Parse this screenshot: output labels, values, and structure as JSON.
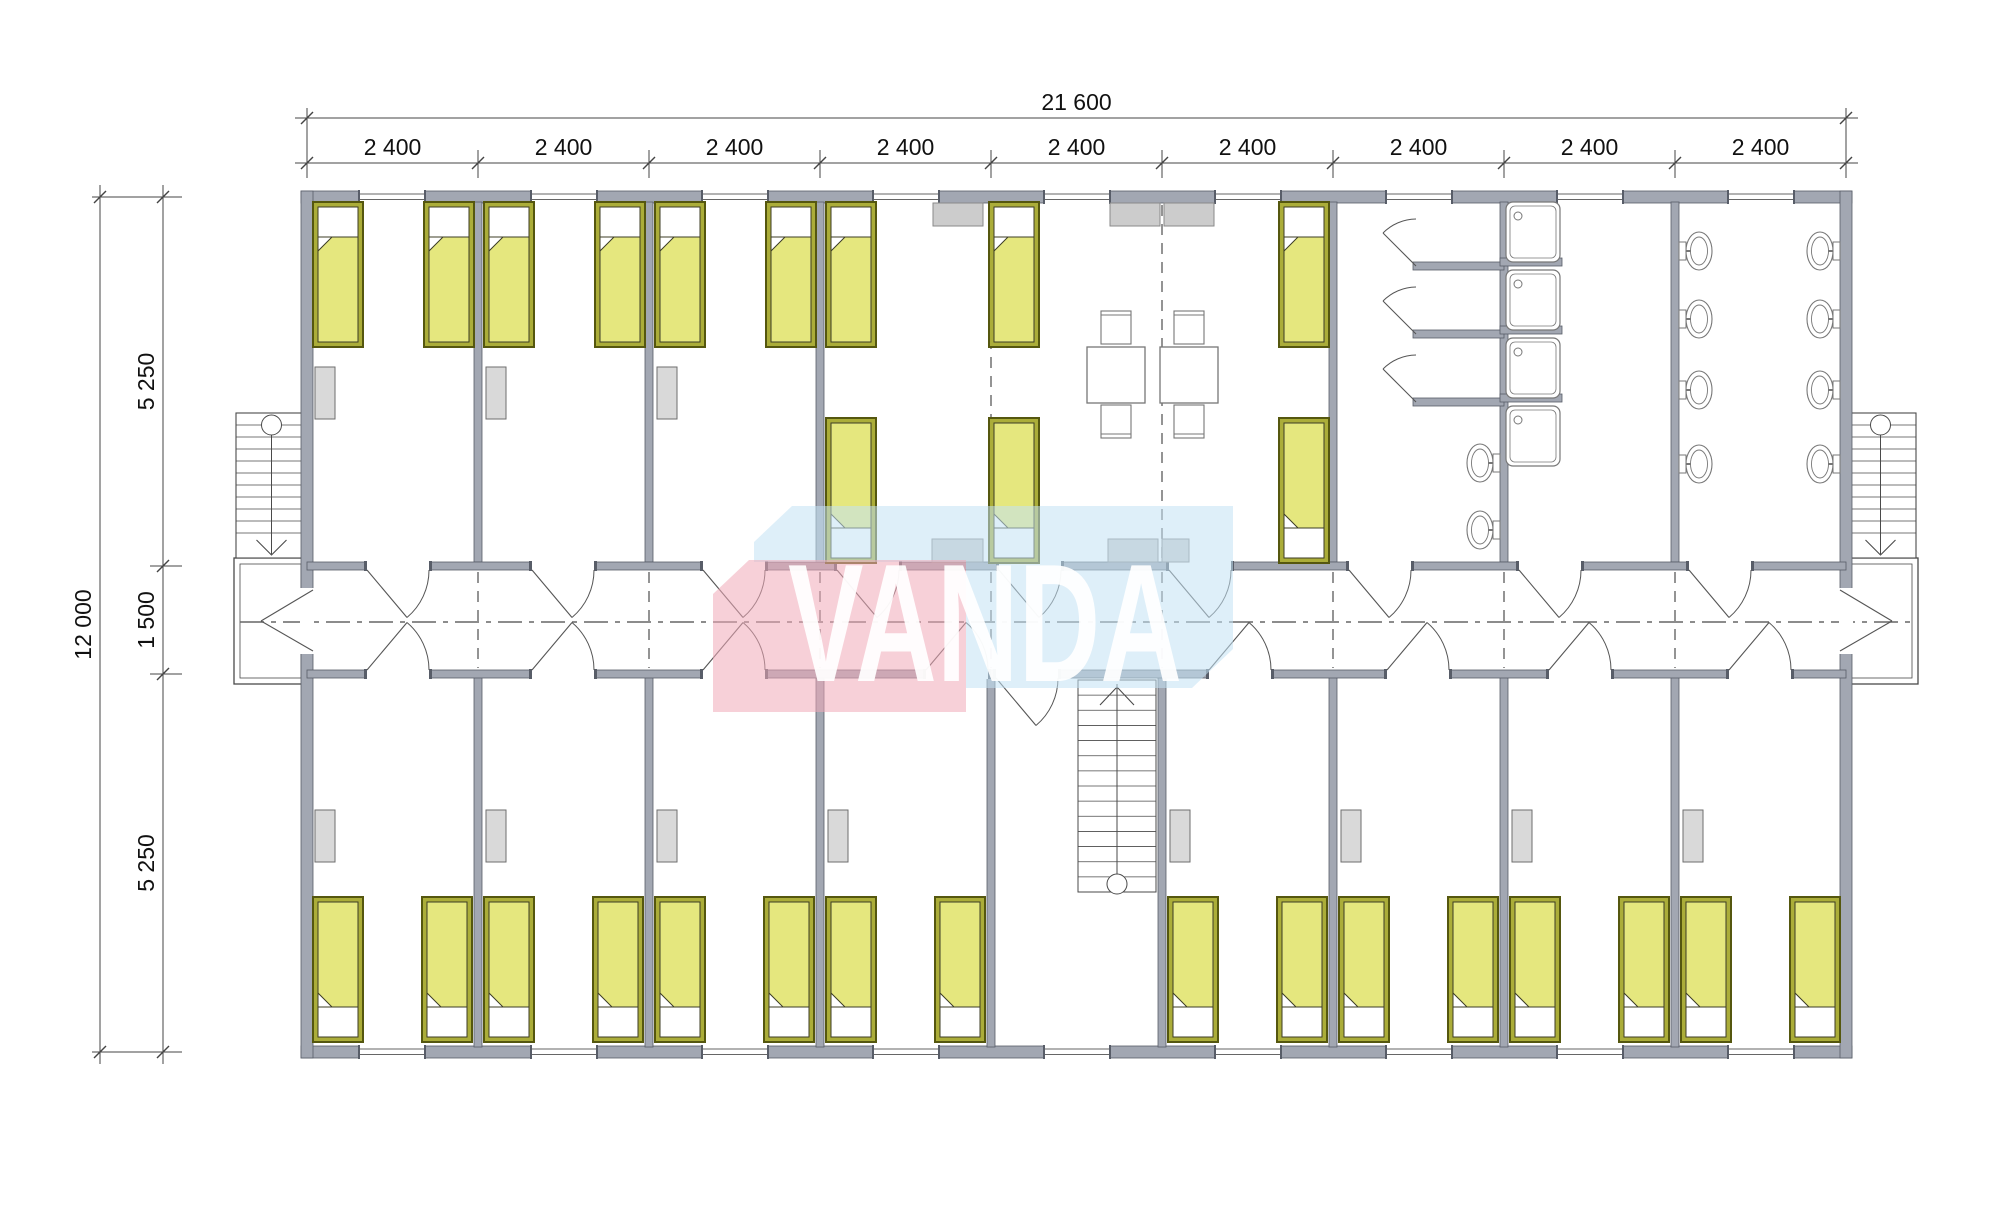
{
  "dimensions": {
    "top_total": "21 600",
    "top_segment_labels": [
      "2 400",
      "2 400",
      "2 400",
      "2 400",
      "2 400",
      "2 400",
      "2 400",
      "2 400",
      "2 400"
    ],
    "left_total": "12 000",
    "left_segment_labels": [
      "5 250",
      "1 500",
      "5 250"
    ]
  },
  "watermark": {
    "text": "VANDA",
    "pink": "#f0a9b8",
    "blue": "#c2e2f4",
    "text_color": "#ffffff",
    "pink_points": "713,594 749,560 966,560 966,712 713,712",
    "blue_points": "754,542 792,506 1233,506 1233,649 1192,688 966,688 966,562 754,562",
    "text_x": 788,
    "text_y": 681,
    "text_size": 168,
    "text_length": 394
  },
  "colors": {
    "wall_fill": "#a2a7b2",
    "wall_edge": "#585d68",
    "thin_line": "#666666",
    "dim_line": "#444444",
    "dim_text": "#111111",
    "bed_frame": "#abad39",
    "bed_frame_edge": "#55570f",
    "mattress": "#e5e77e",
    "mattress_edge": "#3c3c25",
    "pillow": "#ffffff",
    "wardrobe_fill": "#d9d9d9",
    "wardrobe_edge": "#6e6e6e",
    "cabinet_fill": "#cccccc",
    "cabinet_edge": "#8a8a8a",
    "fixture_line": "#777777",
    "stair_line": "#4a4a4a"
  },
  "plan": {
    "x0": 307,
    "module": 171,
    "modules": 9,
    "y_top": 197,
    "y_corr_top": 566,
    "y_corr_bot": 674,
    "y_bot": 1052,
    "ext_thick": 12,
    "int_thick": 8,
    "solid_partitions_top": [
      478,
      649,
      820,
      1333,
      1504,
      1675
    ],
    "dashed_partitions_top": [
      991,
      1162
    ],
    "partitions_bottom": [
      478,
      649,
      820,
      991,
      1162,
      1333,
      1504,
      1675
    ],
    "window_centers": [
      392,
      564,
      735,
      906,
      1077,
      1248,
      1419,
      1590,
      1761
    ],
    "top_doors": [
      398,
      563,
      734,
      868,
      1030,
      1200,
      1380,
      1550,
      1720
    ],
    "bottom_doors_up": [
      398,
      563,
      734,
      957,
      1240,
      1418,
      1580,
      1760
    ],
    "bottom_doors_down": [
      1027
    ],
    "beds_top": [
      313,
      424,
      484,
      595,
      655,
      766,
      826,
      989,
      1279
    ],
    "beds_mid_low": [
      826,
      989,
      1279
    ],
    "beds_bottom": [
      313,
      422,
      484,
      593,
      655,
      764,
      826,
      935,
      1168,
      1277,
      1339,
      1448,
      1510,
      1619,
      1681,
      1790
    ],
    "bed_y_top": 202,
    "bed_y_mid": 418,
    "bed_y_bottom": 897,
    "bed_w": 50,
    "bed_h": 145,
    "wardrobes_top": [
      {
        "x": 315,
        "y": 367
      },
      {
        "x": 486,
        "y": 367
      },
      {
        "x": 657,
        "y": 367
      }
    ],
    "wardrobes_bottom": [
      {
        "x": 315,
        "y": 810
      },
      {
        "x": 486,
        "y": 810
      },
      {
        "x": 657,
        "y": 810
      },
      {
        "x": 828,
        "y": 810
      },
      {
        "x": 1170,
        "y": 810
      },
      {
        "x": 1341,
        "y": 810
      },
      {
        "x": 1512,
        "y": 810
      },
      {
        "x": 1683,
        "y": 810
      }
    ],
    "wardrobe_w": 20,
    "wardrobe_h": 52,
    "cabinets": [
      {
        "x": 933,
        "y": 203,
        "w": 50,
        "h": 23
      },
      {
        "x": 1110,
        "y": 203,
        "w": 50,
        "h": 23
      },
      {
        "x": 1164,
        "y": 203,
        "w": 50,
        "h": 23
      },
      {
        "x": 932,
        "y": 539,
        "w": 51,
        "h": 23
      },
      {
        "x": 1108,
        "y": 539,
        "w": 50,
        "h": 23
      },
      {
        "x": 1162,
        "y": 539,
        "w": 27,
        "h": 23
      }
    ],
    "tables": [
      {
        "x": 1087,
        "y": 347
      },
      {
        "x": 1160,
        "y": 347
      }
    ],
    "table_w": 58,
    "table_h": 56,
    "chairs": [
      {
        "x": 1101,
        "y": 311,
        "back": "top"
      },
      {
        "x": 1101,
        "y": 405,
        "back": "bottom"
      },
      {
        "x": 1174,
        "y": 311,
        "back": "top"
      },
      {
        "x": 1174,
        "y": 405,
        "back": "bottom"
      }
    ],
    "chair_w": 30,
    "chair_h": 33,
    "toilets": [
      {
        "face": 1679,
        "cy": 251,
        "dir": 1
      },
      {
        "face": 1679,
        "cy": 319,
        "dir": 1
      },
      {
        "face": 1679,
        "cy": 390,
        "dir": 1
      },
      {
        "face": 1679,
        "cy": 464,
        "dir": 1
      },
      {
        "face": 1840,
        "cy": 251,
        "dir": -1
      },
      {
        "face": 1840,
        "cy": 319,
        "dir": -1
      },
      {
        "face": 1840,
        "cy": 390,
        "dir": -1
      },
      {
        "face": 1840,
        "cy": 464,
        "dir": -1
      },
      {
        "face": 1500,
        "cy": 463,
        "dir": -1
      },
      {
        "face": 1500,
        "cy": 530,
        "dir": -1
      }
    ],
    "shower_trays": [
      {
        "x": 1506,
        "y": 202
      },
      {
        "x": 1506,
        "y": 270
      },
      {
        "x": 1506,
        "y": 338
      },
      {
        "x": 1506,
        "y": 406
      }
    ],
    "tray_w": 54,
    "tray_h": 60,
    "shower_stubs_right": [
      262,
      330,
      398
    ],
    "shower_stubs_left": [
      266,
      334,
      402
    ],
    "shower_doors": [
      266,
      334,
      402
    ],
    "stairs_ext": [
      {
        "x": 236,
        "y": 413,
        "w": 71,
        "h": 145
      },
      {
        "x": 1845,
        "y": 413,
        "w": 71,
        "h": 145
      }
    ],
    "stair_int": {
      "x": 1078,
      "y": 680,
      "w": 78,
      "h": 212
    },
    "porches": [
      {
        "x": 234,
        "y": 558,
        "w": 73,
        "h": 126
      },
      {
        "x": 1845,
        "y": 558,
        "w": 73,
        "h": 126
      }
    ],
    "end_doors": [
      {
        "wx": 307,
        "side": -1
      },
      {
        "wx": 1846,
        "side": 1
      }
    ]
  }
}
